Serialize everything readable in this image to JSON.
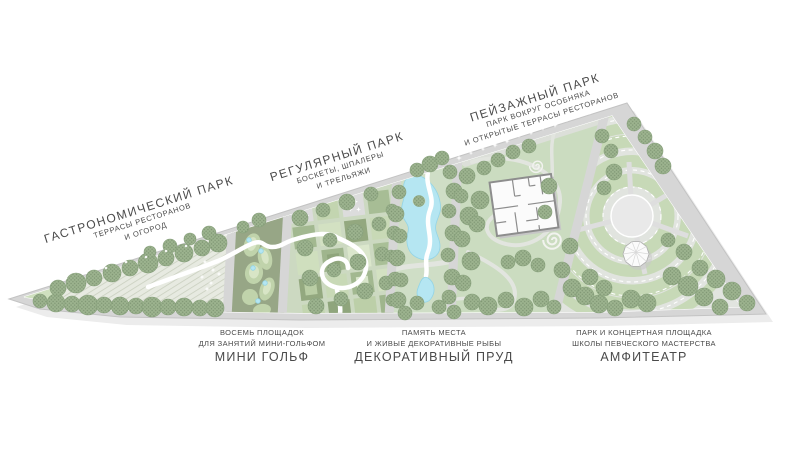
{
  "plan": {
    "zones": [
      {
        "id": "gastronomic",
        "title": "ГАСТРОНОМИЧЕСКИЙ ПАРК",
        "subtitle_lines": [
          "ТЕРРАСЫ РЕСТОРАНОВ",
          "И ОГОРОД"
        ]
      },
      {
        "id": "regular",
        "title": "РЕГУЛЯРНЫЙ ПАРК",
        "subtitle_lines": [
          "БОСКЕТЫ, ШПАЛЕРЫ",
          "И ТРЕЛЬЯЖИ"
        ]
      },
      {
        "id": "landscape",
        "title": "ПЕЙЗАЖНЫЙ ПАРК",
        "subtitle_lines": [
          "ПАРК ВОКРУГ ОСОБНЯКА",
          "И ОТКРЫТЫЕ ТЕРРАСЫ РЕСТОРАНОВ"
        ]
      }
    ],
    "features": [
      {
        "id": "minigolf",
        "caption_lines": [
          "ВОСЕМЬ ПЛОЩАДОК",
          "ДЛЯ ЗАНЯТИЙ МИНИ-ГОЛЬФОМ"
        ],
        "name": "МИНИ ГОЛЬФ"
      },
      {
        "id": "pond",
        "caption_lines": [
          "ПАМЯТЬ МЕСТА",
          "И ЖИВЫЕ ДЕКОРАТИВНЫЕ РЫБЫ"
        ],
        "name": "ДЕКОРАТИВНЫЙ ПРУД"
      },
      {
        "id": "amphitheater",
        "caption_lines": [
          "ПАРК И КОНЦЕРТНАЯ ПЛОЩАДКА",
          "ШКОЛЫ ПЕВЧЕСКОГО МАСТЕРСТВА"
        ],
        "name": "АМФИТЕАТР"
      }
    ]
  },
  "palette": {
    "background": "#ffffff",
    "plan_shadow": "#ececec",
    "road": "#d6d6d6",
    "road_edge": "#c3c3c3",
    "park_base": "#e4e8df",
    "gastro_bed": "#e7eae1",
    "hatch_line": "#c9cfbf",
    "minigolf_green": "#97a686",
    "blob_green": "#c0d3ab",
    "blob_light": "#d8e5c6",
    "grid_bg": "#ccd9c1",
    "pond_bg": "#cfdec6",
    "land_bg": "#cbdcc0",
    "amphi_bg": "#e1e4df",
    "ring_green": "#c7d9b7",
    "plaza_gray": "#dcdcdc",
    "tree_base": "#9db48f",
    "tree_dot": "#7f9674",
    "tree_edge": "#87a07b",
    "water": "#b5e6f2",
    "water_edge": "#93d4e6",
    "path_white": "#ffffff",
    "path_gray": "#e2e5df",
    "building_fill": "#fbfbfb",
    "building_line": "#8d8d8d",
    "label_text": "#4a4a4a"
  }
}
